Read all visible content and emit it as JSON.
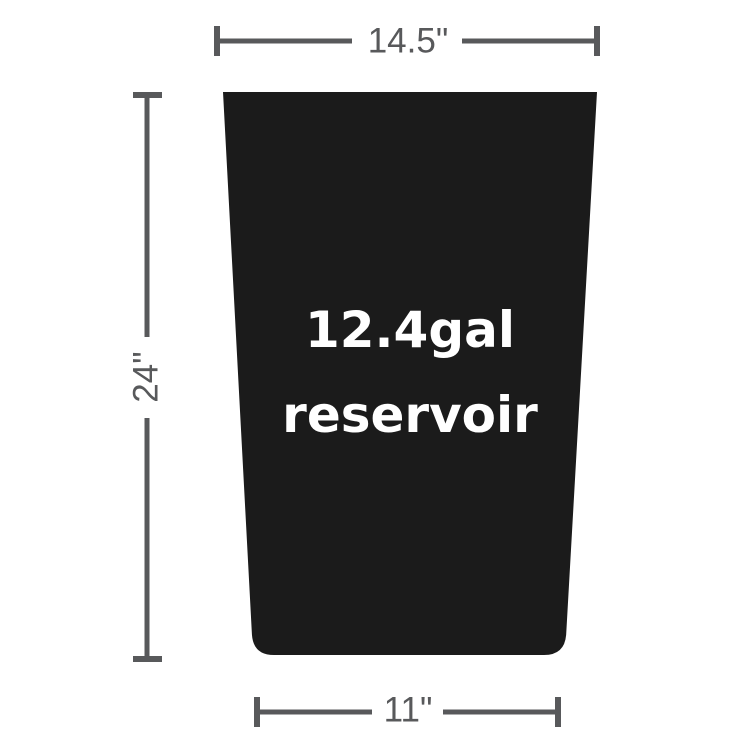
{
  "page": {
    "background_color": "#ffffff"
  },
  "diagram": {
    "reservoir": {
      "capacity": "12.4gal",
      "label": "reservoir",
      "fill_color": "#1b1b1b",
      "text_color": "#ffffff"
    },
    "dimensions": {
      "top_width": "14.5\"",
      "height": "24\"",
      "bottom_width": "11\"",
      "line_color": "#58595b"
    }
  }
}
